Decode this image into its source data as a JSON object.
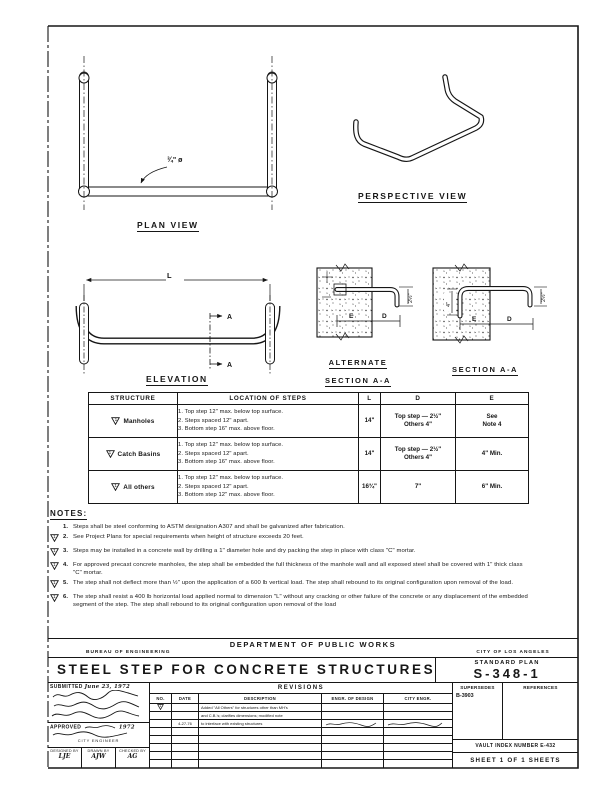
{
  "sheet": {
    "ink": "#161616",
    "paper": "#ffffff"
  },
  "views": {
    "plan": {
      "label": "PLAN VIEW",
      "diameter_callout": "¾\" ø"
    },
    "perspective": {
      "label": "PERSPECTIVE VIEW"
    },
    "elevation": {
      "label": "ELEVATION",
      "length_dim": "L",
      "section_letter": "A"
    },
    "alt_section": {
      "label_line1": "ALTERNATE",
      "label_line2": "SECTION A-A",
      "dim_e": "E",
      "dim_d": "D",
      "dim_drop": "2½\""
    },
    "section": {
      "label": "SECTION A-A",
      "dim_e": "E",
      "dim_d": "D",
      "dim_drop": "2½\"",
      "dim_embed": "4\""
    }
  },
  "table": {
    "headers": {
      "structure": "STRUCTURE",
      "location": "LOCATION OF STEPS",
      "l": "L",
      "d": "D",
      "e": "E"
    },
    "rows": [
      {
        "flag": "1",
        "structure": "Manholes",
        "step1": "1. Top step 12\" max. below top surface.",
        "step2": "2. Steps spaced 12\" apart.",
        "step3": "3. Bottom step 16\" max. above floor.",
        "l": "14\"",
        "d1": "Top step — 2½\"",
        "d2": "Others 4\"",
        "e1": "See",
        "e2": "Note 4"
      },
      {
        "flag": "1",
        "structure": "Catch Basins",
        "step1": "1. Top step 12\" max. below top surface.",
        "step2": "2. Steps spaced 12\" apart.",
        "step3": "3. Bottom step 16\" max. above floor.",
        "l": "14\"",
        "d1": "Top step — 2½\"",
        "d2": "Others 4\"",
        "e1": "4\" Min.",
        "e2": ""
      },
      {
        "flag": "1",
        "structure": "All others",
        "step1": "1. Top step 12\" max. below top surface.",
        "step2": "2. Steps spaced 12\" apart.",
        "step3": "3. Bottom step 12\" max. above floor.",
        "l": "16¾\"",
        "d1": "7\"",
        "d2": "",
        "e1": "6\" Min.",
        "e2": ""
      }
    ]
  },
  "notes": {
    "heading": "NOTES:",
    "items": [
      {
        "flag": "",
        "num": "1.",
        "text": "Steps shall be steel conforming to ASTM designation A307 and shall be galvanized after fabrication."
      },
      {
        "flag": "1",
        "num": "2.",
        "text": "See Project Plans for special requirements when height of structure exceeds 20 feet."
      },
      {
        "flag": "1",
        "num": "3.",
        "text": "Steps may be installed in a concrete wall by drilling a 1\" diameter hole and dry packing the step in place with class \"C\" mortar."
      },
      {
        "flag": "1",
        "num": "4.",
        "text": "For approved precast concrete manholes, the step shall be embedded the full thickness of the manhole wall and all exposed steel shall be covered with 1\" thick class \"C\" mortar."
      },
      {
        "flag": "1",
        "num": "5.",
        "text": "The step shall not deflect more than ½\" upon the application of a 600 lb vertical load. The step shall rebound to its original configuration upon removal of the load."
      },
      {
        "flag": "1",
        "num": "6.",
        "text": "The step shall resist a 400 lb horizontal load applied normal to dimension \"L\" without any cracking or other failure of the concrete or any displacement of the embedded segment of the step. The step shall rebound to its original configuration upon removal of the load"
      }
    ]
  },
  "titleblock": {
    "department": "DEPARTMENT OF PUBLIC WORKS",
    "bureau": "BUREAU OF ENGINEERING",
    "city": "CITY OF LOS ANGELES",
    "title": "STEEL STEP FOR CONCRETE STRUCTURES",
    "standard_plan_label": "STANDARD PLAN",
    "plan_number": "S-348-1",
    "submitted_label": "SUBMITTED",
    "submitted_date": "June 23, 1972",
    "approved_label": "APPROVED",
    "approved_year": "1972",
    "approved_title": "CITY ENGINEER",
    "designed_by_label": "DESIGNED BY",
    "designed_by": "LJE",
    "drawn_by_label": "DRAWN BY",
    "drawn_by": "AJW",
    "checked_by_label": "CHECKED BY",
    "checked_by": "AG",
    "revisions": {
      "heading": "REVISIONS",
      "col_no": "NO.",
      "col_date": "DATE",
      "col_desc": "DESCRIPTION",
      "col_engr": "ENGR. OF DESIGN",
      "col_city": "CITY ENGR.",
      "rows": [
        {
          "flag": "1",
          "date": "",
          "desc": "Added \"All Others\" for structures other than MH's"
        },
        {
          "flag": "",
          "date": "",
          "desc": "and C.B.'s; clarifies dimensions; modified note"
        },
        {
          "flag": "",
          "date": "4-27-76",
          "desc": "to interface with existing structures"
        }
      ]
    },
    "supersedes_label": "SUPERSEDES",
    "supersedes_value": "B-3903",
    "references_label": "REFERENCES",
    "vault_index": "VAULT INDEX NUMBER E-432",
    "sheet_line": "SHEET 1 OF 1 SHEETS"
  }
}
